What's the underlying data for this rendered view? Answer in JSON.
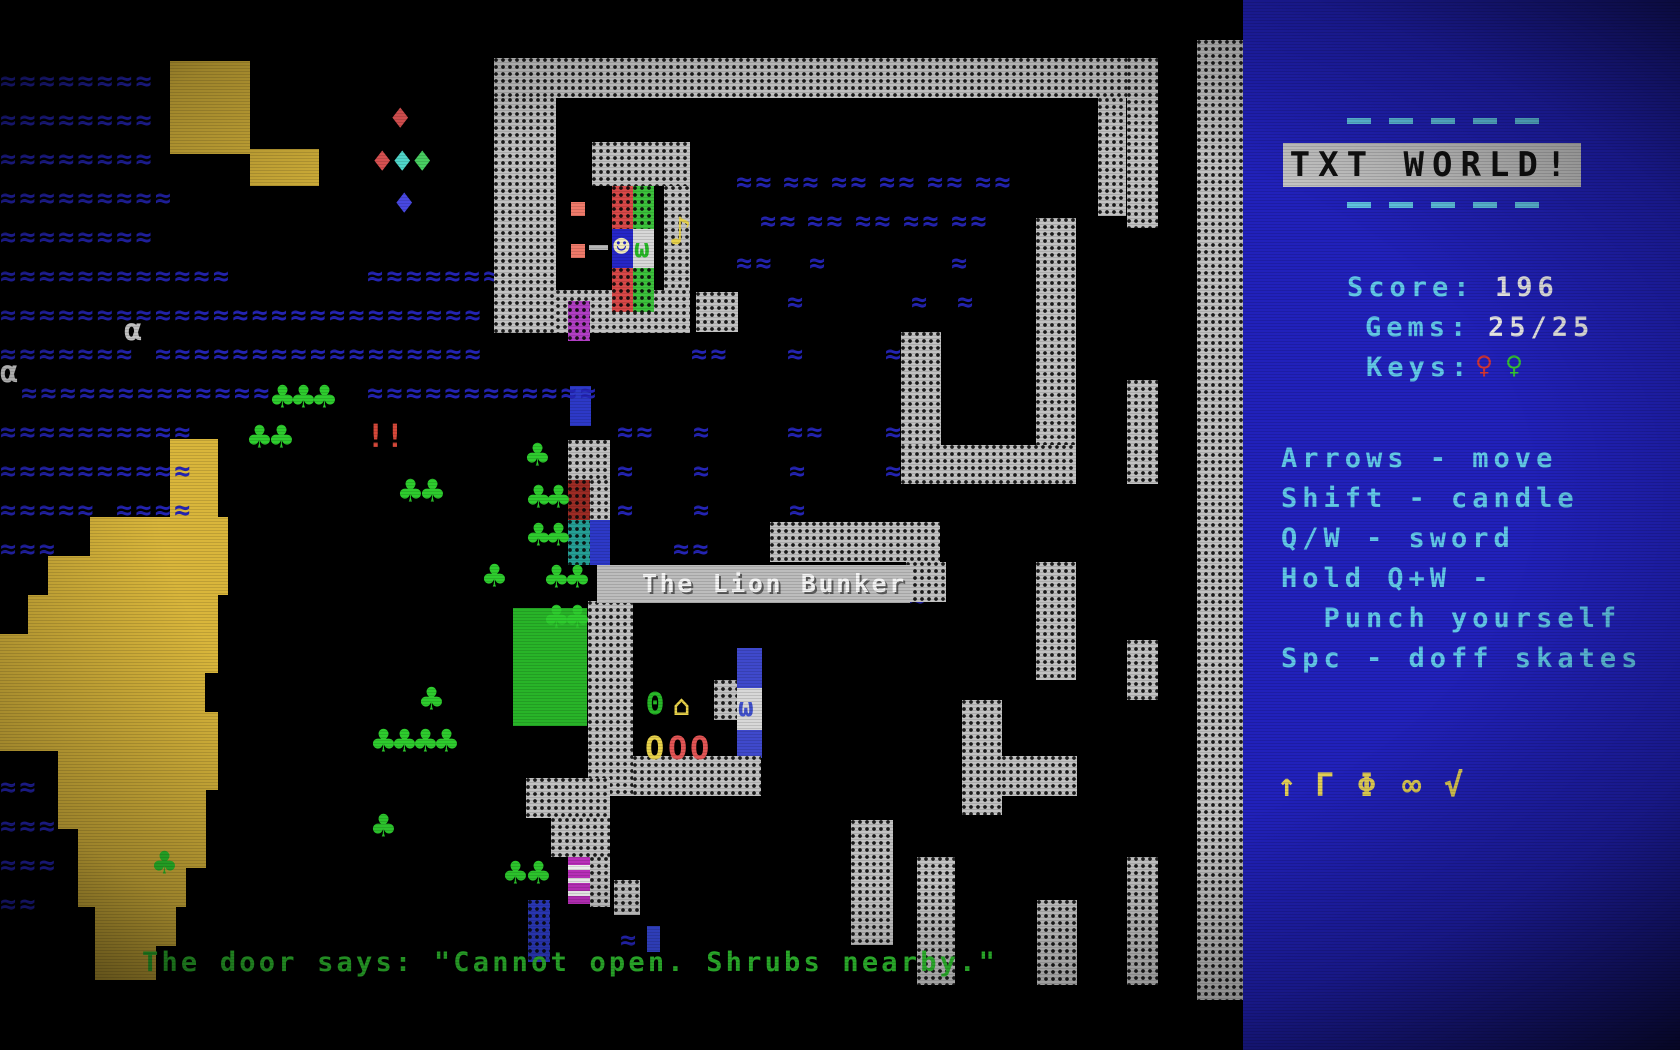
{
  "sidebar": {
    "title": "TXT WORLD!",
    "score_label": "Score:",
    "score_value": "196",
    "gems_label": "Gems:",
    "gems_value": "25/25",
    "keys_label": "Keys:",
    "keys": [
      {
        "glyph": "♀",
        "color": "#d03434",
        "name": "red-key-icon"
      },
      {
        "glyph": "♀",
        "color": "#35c435",
        "name": "green-key-icon"
      }
    ],
    "instructions": [
      "Arrows - move",
      "Shift - candle",
      "Q/W - sword",
      "Hold Q+W -",
      "  Punch yourself",
      "Spc - doff skates"
    ],
    "inventory_icons": [
      {
        "glyph": "↑",
        "name": "up-arrow-icon"
      },
      {
        "glyph": "Γ",
        "name": "gamma-icon"
      },
      {
        "glyph": "Φ",
        "name": "phi-icon"
      },
      {
        "glyph": "∞",
        "name": "infinity-icon"
      },
      {
        "glyph": "√",
        "name": "radical-icon"
      }
    ],
    "colors": {
      "panel": "#2121bb",
      "text_cyan": "#62c8e8",
      "text_white": "#ebebeb",
      "banner_bg": "#c6c6c6",
      "icons_yellow": "#e3cf56"
    }
  },
  "board": {
    "label": "The Lion Bunker",
    "message": "The door says: \"Cannot open. Shrubs nearby.\"",
    "colors": {
      "water": "#2424b4",
      "terrain": "#d9b63b",
      "tree": "#2ecc2e",
      "message_green": "#2fbf2f",
      "wall_gray": "#c2c2c2"
    },
    "water_runs": [
      [
        0,
        61,
        8
      ],
      [
        0,
        100,
        8
      ],
      [
        0,
        139,
        8
      ],
      [
        0,
        178,
        9
      ],
      [
        0,
        217,
        8
      ],
      [
        0,
        256,
        12
      ],
      [
        367,
        256,
        7
      ],
      [
        0,
        295,
        25
      ],
      [
        0,
        334,
        7
      ],
      [
        155,
        334,
        17
      ],
      [
        21,
        373,
        13
      ],
      [
        367,
        373,
        12
      ],
      [
        0,
        412,
        10
      ],
      [
        0,
        451,
        10
      ],
      [
        0,
        490,
        5
      ],
      [
        116,
        490,
        4
      ],
      [
        0,
        529,
        3
      ],
      [
        736,
        162,
        2
      ],
      [
        783,
        162,
        2
      ],
      [
        831,
        162,
        2
      ],
      [
        879,
        162,
        2
      ],
      [
        927,
        162,
        2
      ],
      [
        975,
        162,
        2
      ],
      [
        760,
        201,
        2
      ],
      [
        807,
        201,
        2
      ],
      [
        855,
        201,
        2
      ],
      [
        903,
        201,
        2
      ],
      [
        951,
        201,
        2
      ],
      [
        736,
        243,
        2
      ],
      [
        809,
        243,
        1
      ],
      [
        951,
        243,
        1
      ],
      [
        787,
        282,
        1
      ],
      [
        911,
        282,
        1
      ],
      [
        957,
        282,
        1
      ],
      [
        691,
        334,
        2
      ],
      [
        787,
        334,
        1
      ],
      [
        885,
        334,
        1
      ],
      [
        617,
        412,
        2
      ],
      [
        693,
        412,
        1
      ],
      [
        787,
        412,
        2
      ],
      [
        885,
        412,
        1
      ],
      [
        617,
        451,
        1
      ],
      [
        693,
        451,
        1
      ],
      [
        789,
        451,
        1
      ],
      [
        885,
        451,
        1
      ],
      [
        617,
        490,
        1
      ],
      [
        693,
        490,
        1
      ],
      [
        789,
        490,
        1
      ],
      [
        673,
        529,
        2
      ],
      [
        842,
        529,
        1
      ],
      [
        909,
        578,
        1
      ],
      [
        620,
        920,
        1
      ],
      [
        0,
        767,
        2
      ],
      [
        0,
        806,
        3
      ],
      [
        0,
        845,
        3
      ],
      [
        0,
        884,
        2
      ]
    ],
    "walls": [
      [
        494,
        58,
        633,
        40,
        "gray"
      ],
      [
        494,
        98,
        62,
        235,
        "gray"
      ],
      [
        592,
        142,
        98,
        44,
        "gray"
      ],
      [
        664,
        186,
        26,
        146,
        "gray"
      ],
      [
        556,
        290,
        134,
        43,
        "gray"
      ],
      [
        696,
        292,
        42,
        40,
        "gray"
      ],
      [
        1098,
        98,
        28,
        118,
        "gray"
      ],
      [
        1127,
        58,
        31,
        170,
        "gray"
      ],
      [
        1127,
        380,
        31,
        104,
        "gray"
      ],
      [
        1036,
        218,
        40,
        266,
        "gray"
      ],
      [
        901,
        332,
        40,
        152,
        "gray"
      ],
      [
        901,
        445,
        175,
        39,
        "gray"
      ],
      [
        770,
        522,
        170,
        40,
        "gray"
      ],
      [
        906,
        562,
        40,
        40,
        "gray"
      ],
      [
        1036,
        562,
        40,
        118,
        "gray"
      ],
      [
        588,
        601,
        45,
        195,
        "gray"
      ],
      [
        633,
        756,
        128,
        40,
        "gray"
      ],
      [
        714,
        680,
        23,
        40,
        "gray"
      ],
      [
        526,
        778,
        84,
        40,
        "gray"
      ],
      [
        551,
        818,
        59,
        39,
        "gray"
      ],
      [
        590,
        857,
        20,
        50,
        "gray"
      ],
      [
        614,
        880,
        26,
        35,
        "gray"
      ],
      [
        851,
        820,
        42,
        125,
        "gray"
      ],
      [
        917,
        857,
        38,
        128,
        "gray"
      ],
      [
        1037,
        900,
        40,
        85,
        "gray"
      ],
      [
        1127,
        857,
        31,
        128,
        "gray"
      ],
      [
        962,
        700,
        40,
        115,
        "gray"
      ],
      [
        1002,
        756,
        75,
        40,
        "gray"
      ],
      [
        1127,
        640,
        31,
        60,
        "gray"
      ],
      [
        1197,
        40,
        46,
        960,
        "gray"
      ],
      [
        568,
        440,
        42,
        40,
        "gray"
      ],
      [
        590,
        480,
        20,
        40,
        "gray"
      ],
      [
        568,
        480,
        22,
        40,
        "maroon"
      ],
      [
        568,
        520,
        22,
        45,
        "teal"
      ],
      [
        568,
        301,
        22,
        40,
        "purple"
      ],
      [
        612,
        186,
        21,
        43,
        "red"
      ],
      [
        612,
        268,
        21,
        44,
        "red"
      ],
      [
        633,
        186,
        21,
        43,
        "green"
      ],
      [
        633,
        268,
        21,
        44,
        "green"
      ],
      [
        528,
        900,
        22,
        62,
        "blue"
      ]
    ],
    "cells": [
      [
        170,
        61,
        80,
        93,
        "#d9b63b",
        "yellow-terrain"
      ],
      [
        250,
        149,
        69,
        37,
        "#d9b63b",
        "yellow-terrain"
      ],
      [
        170,
        439,
        48,
        78,
        "#d9b63b",
        "yellow-terrain"
      ],
      [
        90,
        517,
        138,
        39,
        "#d9b63b",
        "yellow-terrain"
      ],
      [
        48,
        556,
        180,
        39,
        "#d9b63b",
        "yellow-terrain"
      ],
      [
        28,
        595,
        190,
        39,
        "#d9b63b",
        "yellow-terrain"
      ],
      [
        0,
        634,
        218,
        39,
        "#d9b63b",
        "yellow-terrain"
      ],
      [
        0,
        673,
        205,
        39,
        "#d9b63b",
        "yellow-terrain"
      ],
      [
        0,
        712,
        218,
        39,
        "#d9b63b",
        "yellow-terrain"
      ],
      [
        58,
        751,
        160,
        39,
        "#d9b63b",
        "yellow-terrain"
      ],
      [
        58,
        790,
        148,
        39,
        "#d9b63b",
        "yellow-terrain"
      ],
      [
        78,
        829,
        128,
        39,
        "#d9b63b",
        "yellow-terrain"
      ],
      [
        78,
        868,
        108,
        39,
        "#d9b63b",
        "yellow-terrain"
      ],
      [
        95,
        907,
        81,
        39,
        "#d9b63b",
        "yellow-terrain"
      ],
      [
        95,
        946,
        61,
        34,
        "#d9b63b",
        "yellow-terrain"
      ],
      [
        513,
        608,
        74,
        118,
        "#28b428",
        "green-block"
      ],
      [
        590,
        520,
        20,
        45,
        "#2d39c8",
        "blue-block"
      ],
      [
        570,
        386,
        21,
        40,
        "#2d39c8",
        "blue-block"
      ],
      [
        647,
        926,
        13,
        26,
        "#3344cc",
        "blue-door"
      ],
      [
        737,
        648,
        25,
        110,
        "#3f49cc",
        "door-column"
      ],
      [
        737,
        688,
        25,
        42,
        "#d8d8d8",
        "door-white-cell"
      ],
      [
        612,
        229,
        21,
        39,
        "#2626c8",
        "player-cell-bg"
      ],
      [
        633,
        229,
        21,
        39,
        "#d8d8d8",
        "creature-cell-bg"
      ],
      [
        571,
        202,
        14,
        14,
        "#ef7a6a",
        "red-pellet"
      ],
      [
        571,
        244,
        14,
        14,
        "#ef7a6a",
        "red-pellet"
      ],
      [
        589,
        245,
        19,
        5,
        "#b8b8b8",
        "bullet-dash"
      ]
    ],
    "sprites": [
      {
        "g": "☻",
        "x": 613,
        "y": 233,
        "c": "#f2ecbe",
        "s": 28,
        "n": "player"
      },
      {
        "g": "ω",
        "x": 634,
        "y": 236,
        "c": "#28b828",
        "s": 26,
        "n": "green-creature"
      },
      {
        "g": "ω",
        "x": 738,
        "y": 695,
        "c": "#4050cc",
        "s": 26,
        "n": "blue-creature"
      },
      {
        "g": "♪",
        "x": 668,
        "y": 212,
        "c": "#e8d24a",
        "s": 40,
        "n": "music-note"
      },
      {
        "g": "♦",
        "x": 390,
        "y": 102,
        "c": "#e35555",
        "s": 34,
        "n": "gem-red"
      },
      {
        "g": "♦",
        "x": 372,
        "y": 145,
        "c": "#e35555",
        "s": 34,
        "n": "gem-red"
      },
      {
        "g": "♦",
        "x": 392,
        "y": 145,
        "c": "#52dfd2",
        "s": 34,
        "n": "gem-cyan"
      },
      {
        "g": "♦",
        "x": 412,
        "y": 145,
        "c": "#4ad464",
        "s": 34,
        "n": "gem-green"
      },
      {
        "g": "♦",
        "x": 394,
        "y": 187,
        "c": "#4848e0",
        "s": 34,
        "n": "gem-blue"
      },
      {
        "g": "!!",
        "x": 366,
        "y": 420,
        "c": "#d5483a",
        "s": 32,
        "n": "exclamation-pair"
      },
      {
        "g": "α",
        "x": 124,
        "y": 316,
        "c": "#d0d0d0",
        "s": 30,
        "n": "alpha-creature"
      },
      {
        "g": "α",
        "x": 0,
        "y": 358,
        "c": "#d0d0d0",
        "s": 30,
        "n": "alpha-creature"
      },
      {
        "g": "Θ",
        "x": 646,
        "y": 690,
        "c": "#28b828",
        "s": 30,
        "n": "theta-creature"
      },
      {
        "g": "⌂",
        "x": 673,
        "y": 692,
        "c": "#e8d24a",
        "s": 28,
        "n": "energizer"
      },
      {
        "g": "O",
        "x": 645,
        "y": 732,
        "c": "#e8d24a",
        "s": 32,
        "n": "boulder-yellow"
      },
      {
        "g": "O",
        "x": 668,
        "y": 732,
        "c": "#e35555",
        "s": 32,
        "n": "boulder-red"
      },
      {
        "g": "O",
        "x": 690,
        "y": 732,
        "c": "#e35555",
        "s": 32,
        "n": "boulder-red"
      },
      {
        "g": "♣",
        "x": 271,
        "y": 378,
        "c": "#2ecc2e",
        "s": 38,
        "n": "tree"
      },
      {
        "g": "♣",
        "x": 292,
        "y": 378,
        "c": "#2ecc2e",
        "s": 38,
        "n": "tree"
      },
      {
        "g": "♣",
        "x": 313,
        "y": 378,
        "c": "#2ecc2e",
        "s": 38,
        "n": "tree"
      },
      {
        "g": "♣",
        "x": 248,
        "y": 418,
        "c": "#2ecc2e",
        "s": 38,
        "n": "tree"
      },
      {
        "g": "♣",
        "x": 270,
        "y": 418,
        "c": "#2ecc2e",
        "s": 38,
        "n": "tree"
      },
      {
        "g": "♣",
        "x": 526,
        "y": 436,
        "c": "#2ecc2e",
        "s": 38,
        "n": "tree"
      },
      {
        "g": "♣",
        "x": 399,
        "y": 472,
        "c": "#2ecc2e",
        "s": 38,
        "n": "tree"
      },
      {
        "g": "♣",
        "x": 421,
        "y": 472,
        "c": "#2ecc2e",
        "s": 38,
        "n": "tree"
      },
      {
        "g": "♣",
        "x": 527,
        "y": 478,
        "c": "#2ecc2e",
        "s": 38,
        "n": "tree"
      },
      {
        "g": "♣",
        "x": 547,
        "y": 478,
        "c": "#2ecc2e",
        "s": 38,
        "n": "tree"
      },
      {
        "g": "♣",
        "x": 527,
        "y": 516,
        "c": "#2ecc2e",
        "s": 38,
        "n": "tree"
      },
      {
        "g": "♣",
        "x": 547,
        "y": 516,
        "c": "#2ecc2e",
        "s": 38,
        "n": "tree"
      },
      {
        "g": "♣",
        "x": 483,
        "y": 557,
        "c": "#2ecc2e",
        "s": 38,
        "n": "tree"
      },
      {
        "g": "♣",
        "x": 545,
        "y": 558,
        "c": "#2ecc2e",
        "s": 38,
        "n": "tree"
      },
      {
        "g": "♣",
        "x": 566,
        "y": 558,
        "c": "#2ecc2e",
        "s": 38,
        "n": "tree"
      },
      {
        "g": "♣",
        "x": 545,
        "y": 598,
        "c": "#2ecc2e",
        "s": 38,
        "n": "tree"
      },
      {
        "g": "♣",
        "x": 566,
        "y": 598,
        "c": "#2ecc2e",
        "s": 38,
        "n": "tree"
      },
      {
        "g": "♣",
        "x": 420,
        "y": 680,
        "c": "#2ecc2e",
        "s": 38,
        "n": "tree"
      },
      {
        "g": "♣",
        "x": 372,
        "y": 722,
        "c": "#2ecc2e",
        "s": 38,
        "n": "tree"
      },
      {
        "g": "♣",
        "x": 393,
        "y": 722,
        "c": "#2ecc2e",
        "s": 38,
        "n": "tree"
      },
      {
        "g": "♣",
        "x": 414,
        "y": 722,
        "c": "#2ecc2e",
        "s": 38,
        "n": "tree"
      },
      {
        "g": "♣",
        "x": 435,
        "y": 722,
        "c": "#2ecc2e",
        "s": 38,
        "n": "tree"
      },
      {
        "g": "♣",
        "x": 372,
        "y": 807,
        "c": "#2ecc2e",
        "s": 38,
        "n": "tree"
      },
      {
        "g": "♣",
        "x": 153,
        "y": 844,
        "c": "#2ecc2e",
        "s": 38,
        "n": "tree"
      },
      {
        "g": "♣",
        "x": 504,
        "y": 854,
        "c": "#2ecc2e",
        "s": 38,
        "n": "tree"
      },
      {
        "g": "♣",
        "x": 527,
        "y": 854,
        "c": "#2ecc2e",
        "s": 38,
        "n": "tree"
      }
    ],
    "scroll": {
      "x": 568,
      "y": 857,
      "w": 22,
      "h": 47
    }
  }
}
